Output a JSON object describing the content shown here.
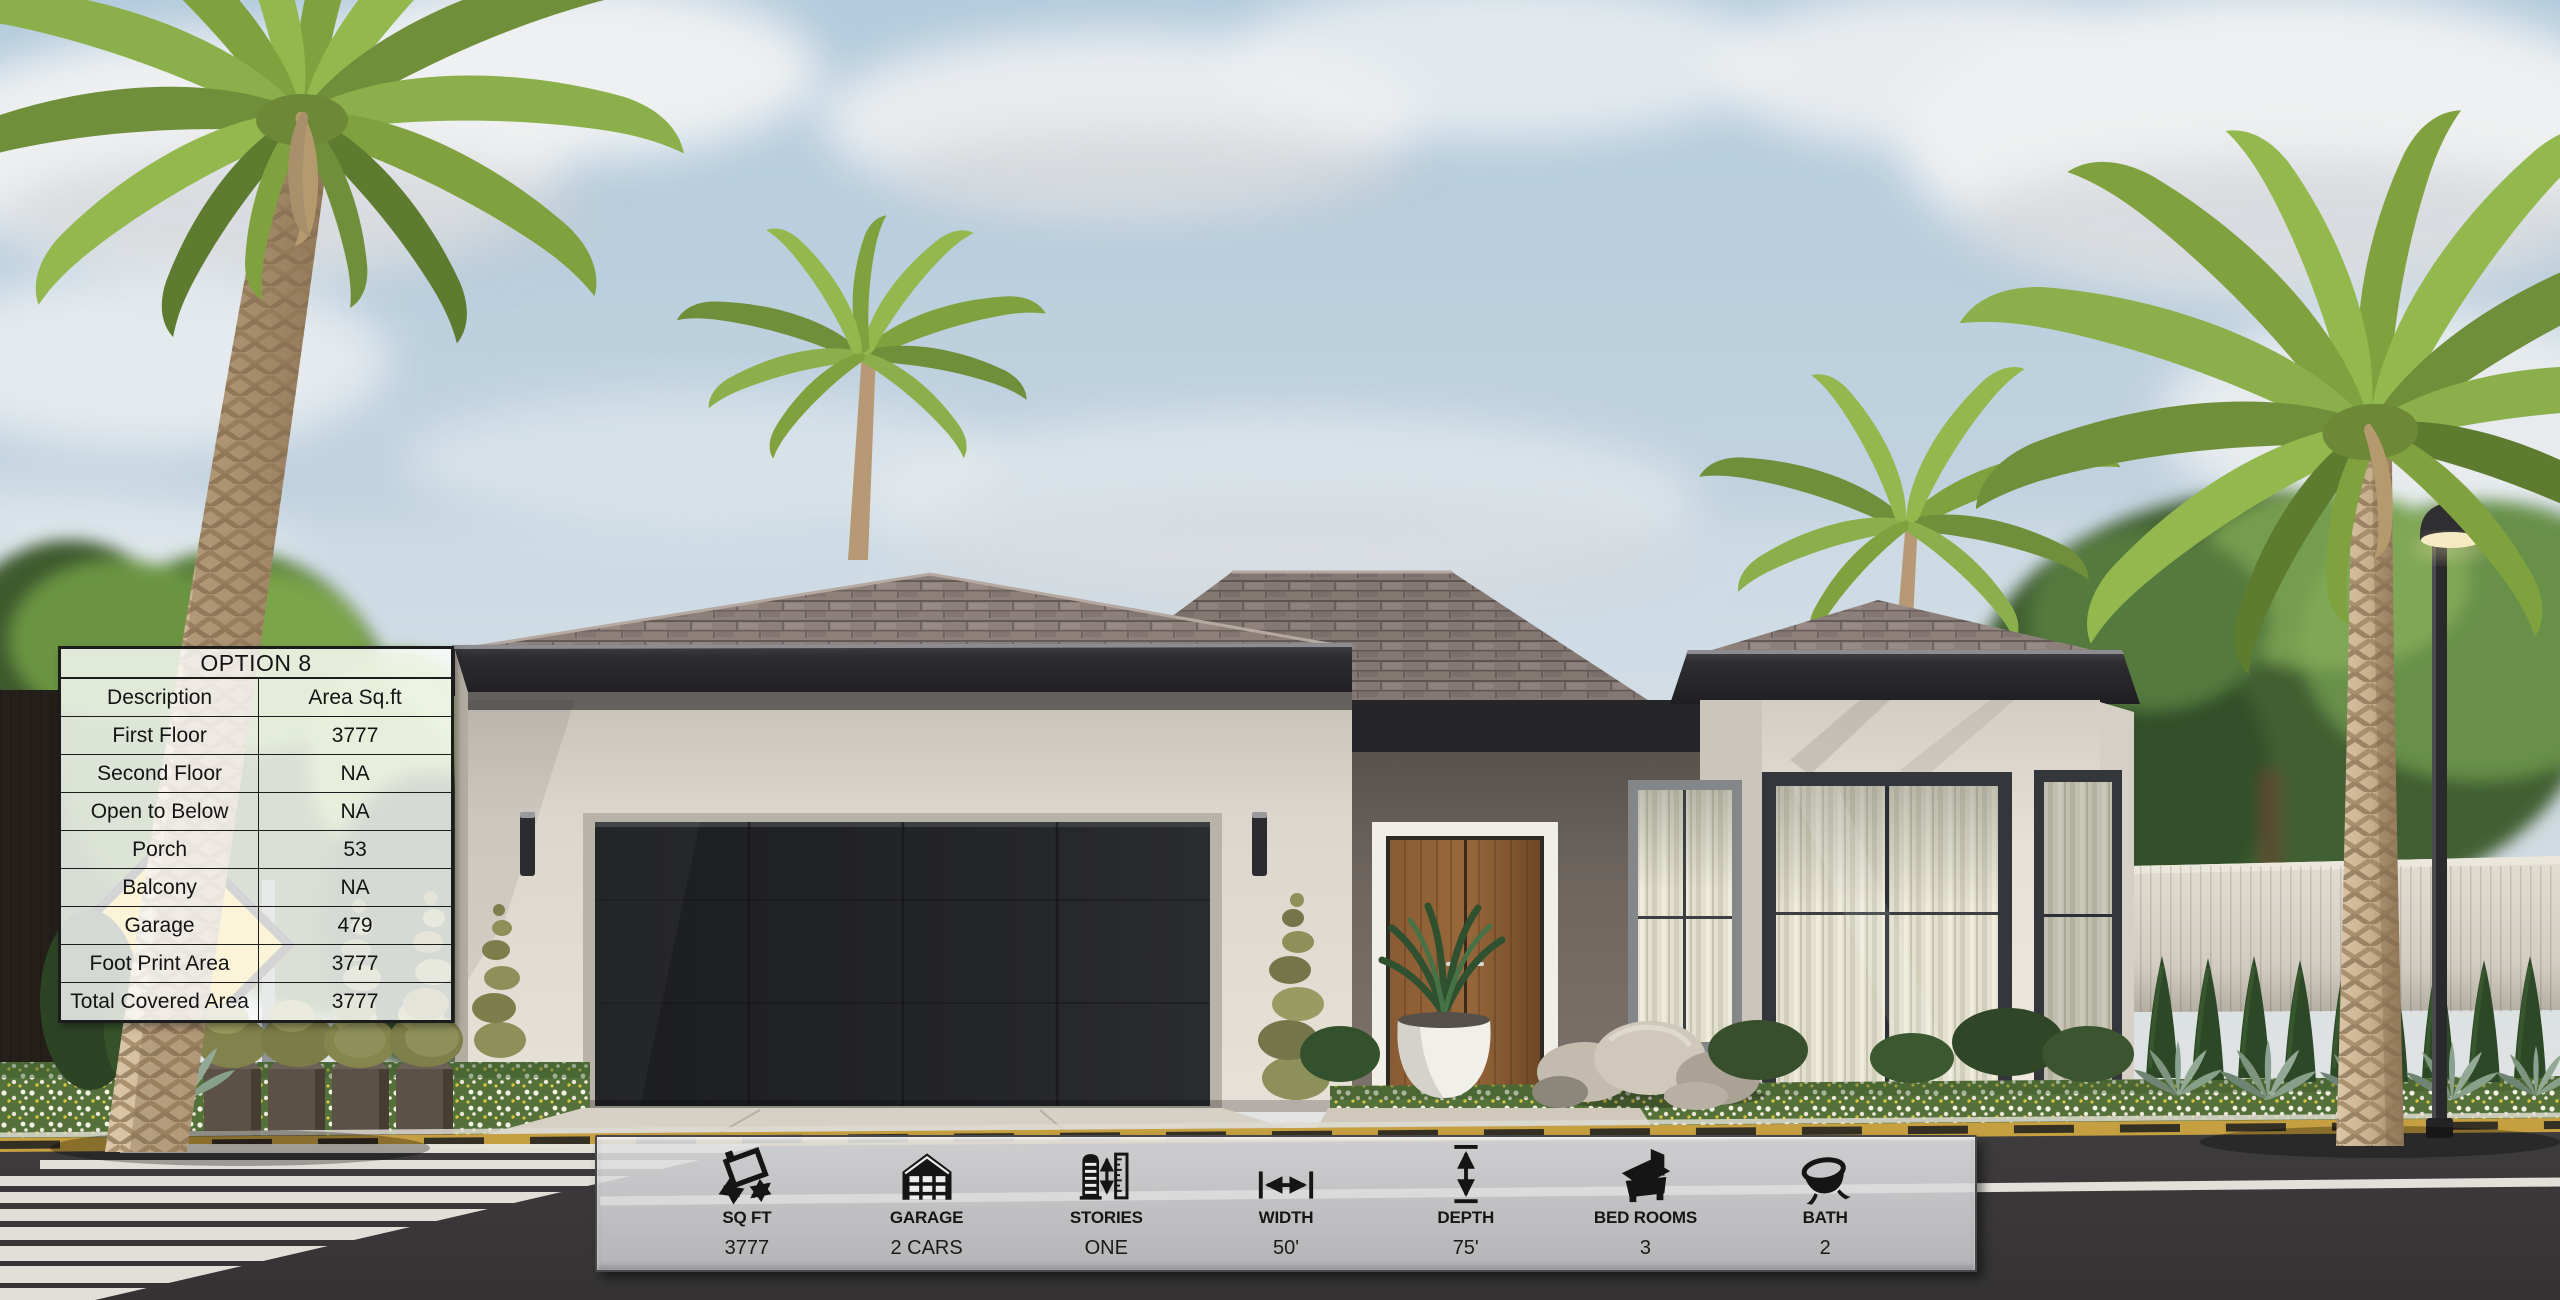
{
  "spec_table": {
    "title": "OPTION 8",
    "rows": [
      [
        "Description",
        "Area Sq.ft"
      ],
      [
        "First Floor",
        "3777"
      ],
      [
        "Second Floor",
        "NA"
      ],
      [
        "Open to Below",
        "NA"
      ],
      [
        "Porch",
        "53"
      ],
      [
        "Balcony",
        "NA"
      ],
      [
        "Garage",
        "479"
      ],
      [
        "Foot Print Area",
        "3777"
      ],
      [
        "Total Covered Area",
        "3777"
      ]
    ]
  },
  "info_bar": {
    "items": [
      {
        "icon": "floor-area-icon",
        "label": "SQ FT",
        "value": "3777"
      },
      {
        "icon": "garage-icon",
        "label": "GARAGE",
        "value": "2 CARS"
      },
      {
        "icon": "stories-icon",
        "label": "STORIES",
        "value": "ONE"
      },
      {
        "icon": "width-icon",
        "label": "WIDTH",
        "value": "50'"
      },
      {
        "icon": "depth-icon",
        "label": "DEPTH",
        "value": "75'"
      },
      {
        "icon": "bedrooms-icon",
        "label": "BED ROOMS",
        "value": "3"
      },
      {
        "icon": "bath-icon",
        "label": "BATH",
        "value": "2"
      }
    ]
  },
  "colors": {
    "table_border": "#1c1c1c",
    "bar_background": "#d4d4d6",
    "bar_border": "#48484a",
    "curb_yellow": "#c69f40",
    "sign_yellow": "#e8c53e",
    "icon_color": "#151515"
  }
}
